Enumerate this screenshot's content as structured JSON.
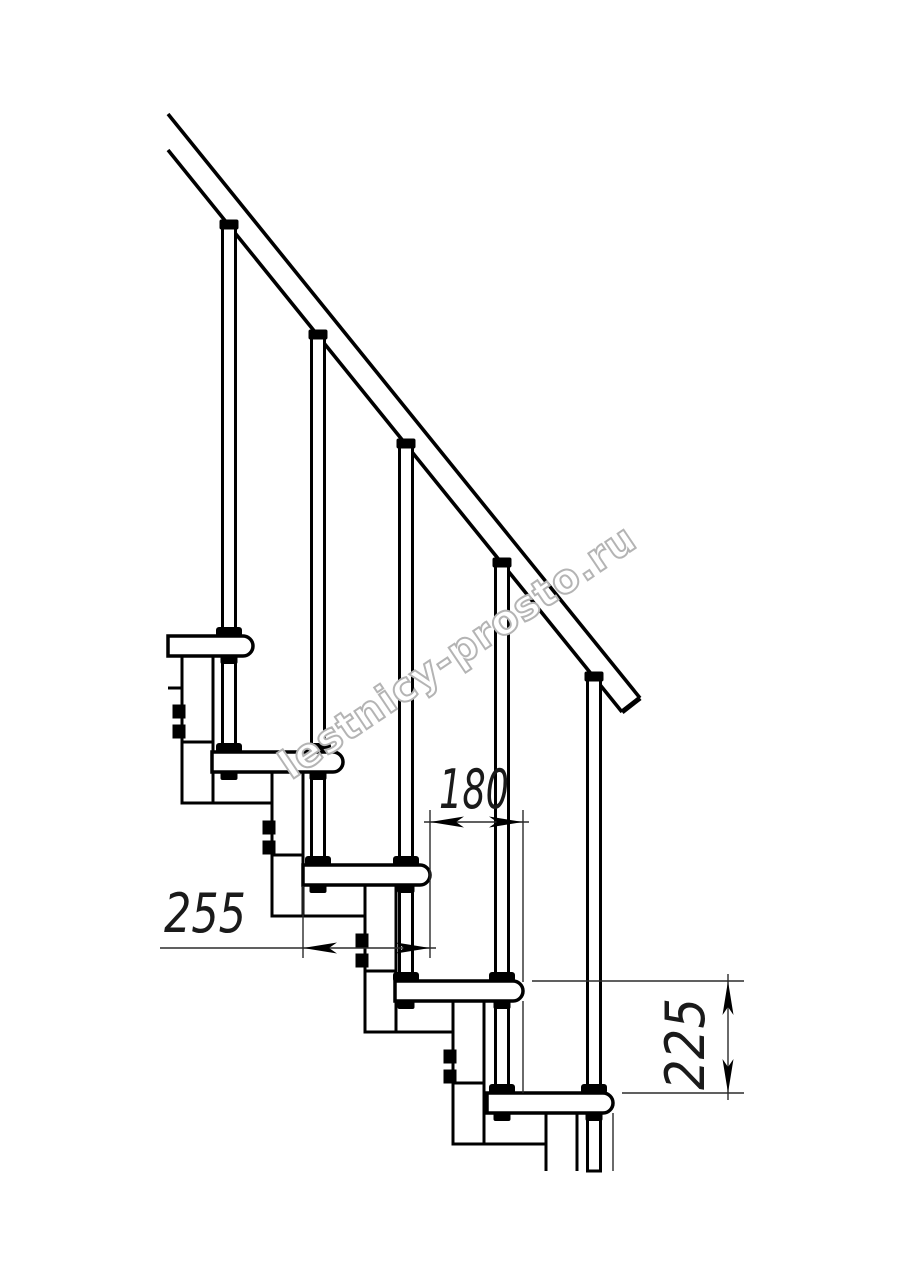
{
  "drawing": {
    "title": "Modular staircase side-view fragment",
    "watermark": {
      "text": "lestnicy-prosto.ru",
      "stroke_color": "#b4b4b4"
    },
    "colors": {
      "background": "#ffffff",
      "line": "#000000",
      "dimension_line": "#2b2b2b",
      "dimension_text": "#1a1a1a"
    },
    "dimensions": {
      "tread_depth": {
        "value": "255"
      },
      "step_run": {
        "value": "180"
      },
      "step_rise": {
        "value": "225"
      }
    }
  }
}
